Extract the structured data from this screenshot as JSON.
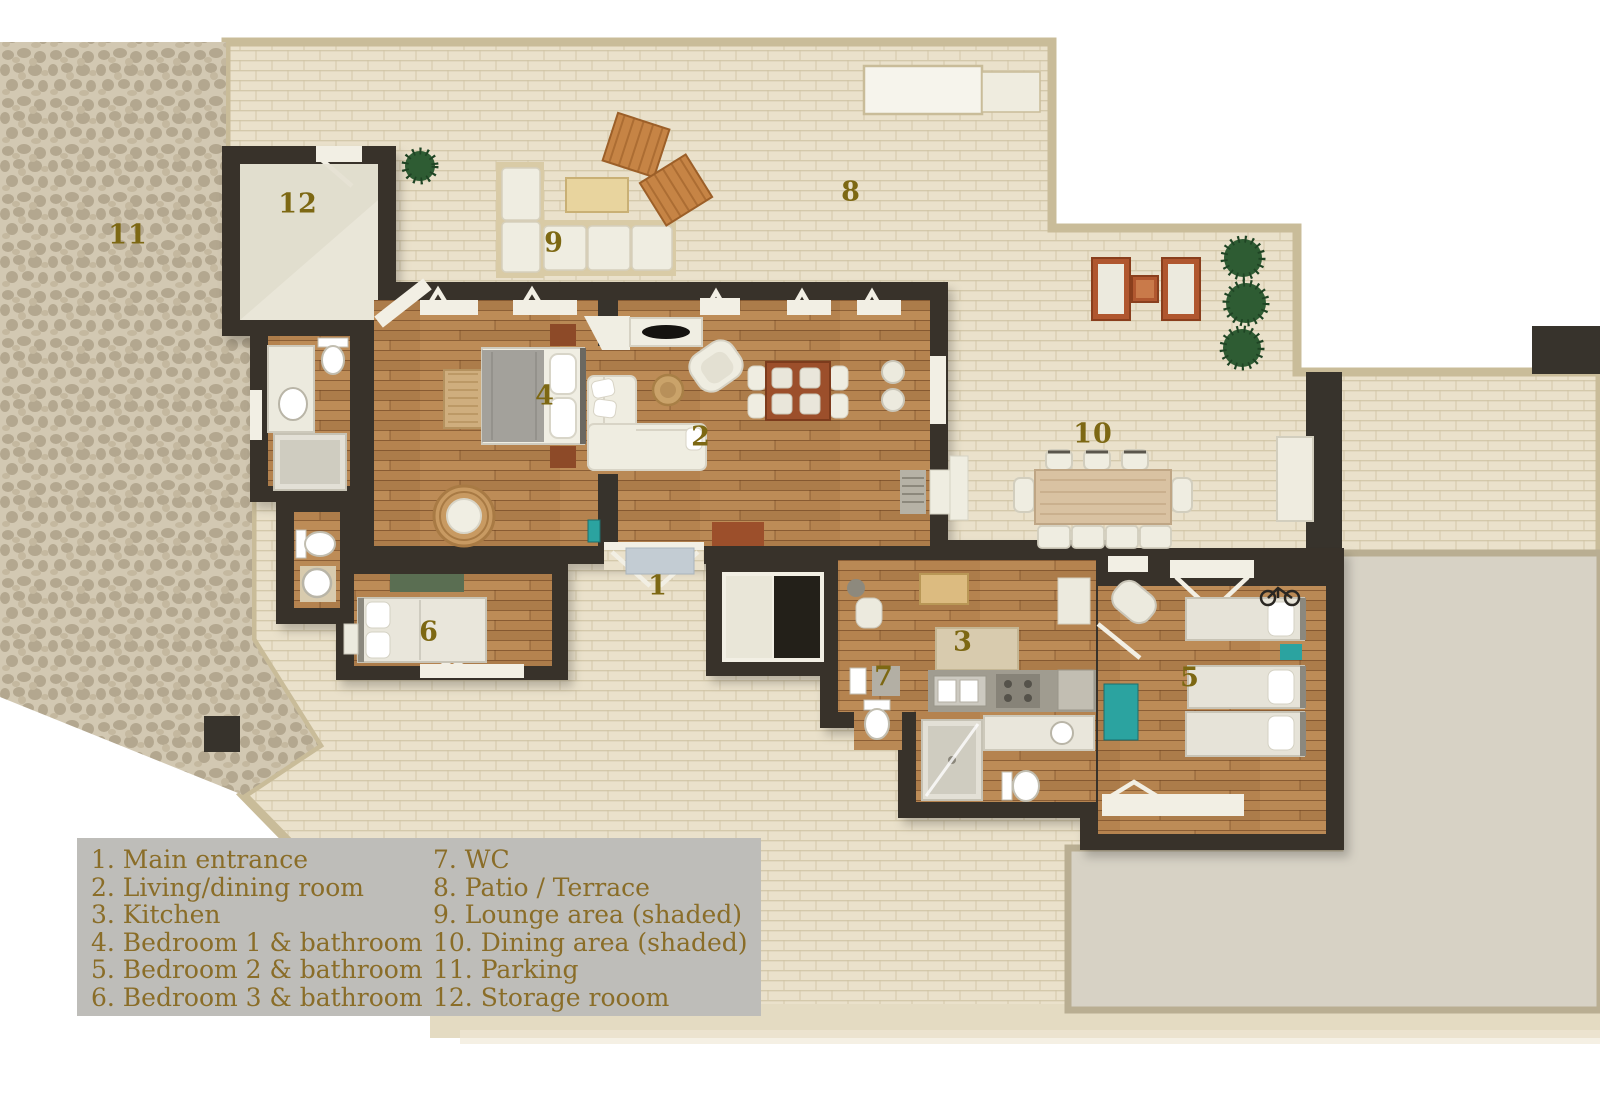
{
  "colors": {
    "wall": "#37332c",
    "wood_floor": "#b5834f",
    "paving": "#eae1cb",
    "paving_border": "#c9bc99",
    "stone_parking": "#d2c8b2",
    "concrete_slab": "#d7d2c5",
    "room_label_gold": "#7d6813",
    "legend_background": "#bebdb9",
    "legend_text": "#8a6d28",
    "accent_teal": "#2ba3a0",
    "furniture_white": "#efede1",
    "plant_green": "#2e5c33"
  },
  "rooms": [
    {
      "num": "1",
      "x": 658,
      "y": 586
    },
    {
      "num": "2",
      "x": 701,
      "y": 437
    },
    {
      "num": "3",
      "x": 963,
      "y": 642
    },
    {
      "num": "4",
      "x": 545,
      "y": 396
    },
    {
      "num": "5",
      "x": 1190,
      "y": 678
    },
    {
      "num": "6",
      "x": 429,
      "y": 632
    },
    {
      "num": "7",
      "x": 884,
      "y": 677
    },
    {
      "num": "8",
      "x": 851,
      "y": 192
    },
    {
      "num": "9",
      "x": 554,
      "y": 243
    },
    {
      "num": "10",
      "x": 1093,
      "y": 434
    },
    {
      "num": "11",
      "x": 128,
      "y": 235
    },
    {
      "num": "12",
      "x": 298,
      "y": 204
    }
  ],
  "legend": {
    "left": [
      "1. Main entrance",
      "2. Living/dining room",
      "3. Kitchen",
      "4. Bedroom 1 & bathroom",
      "5. Bedroom 2 & bathroom",
      "6. Bedroom 3 & bathroom"
    ],
    "right": [
      "7. WC",
      "8. Patio / Terrace",
      "9. Lounge area (shaded)",
      "10. Dining area (shaded)",
      "11. Parking",
      "12. Storage rooom"
    ]
  }
}
